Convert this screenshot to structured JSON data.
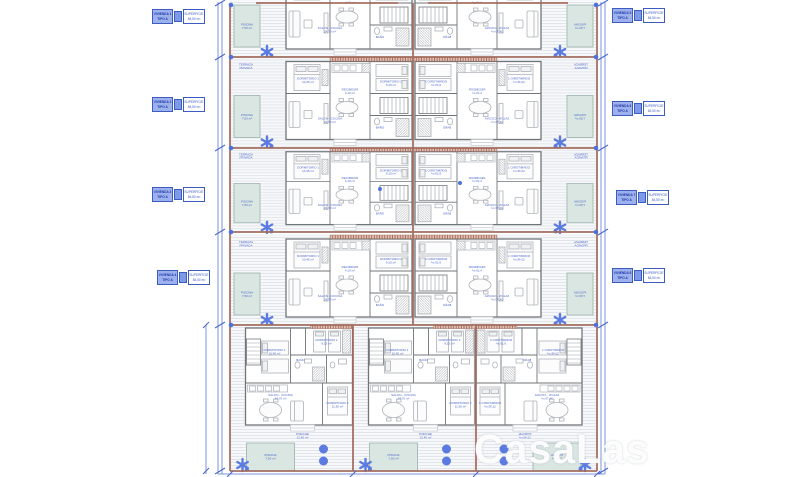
{
  "watermark": "CasaLas",
  "unit_labels": [
    {
      "code_l1": "VIVIENDA 1",
      "code_l2": "TIPO A",
      "info_l1": "SUPERFICIE",
      "info_l2": "84,50 m²"
    },
    {
      "code_l1": "VIVIENDA 2",
      "code_l2": "TIPO A",
      "info_l1": "SUPERFICIE",
      "info_l2": "84,50 m²"
    },
    {
      "code_l1": "VIVIENDA 3",
      "code_l2": "TIPO A",
      "info_l1": "SUPERFICIE",
      "info_l2": "84,50 m²"
    },
    {
      "code_l1": "VIVIENDA 4",
      "code_l2": "TIPO A",
      "info_l1": "SUPERFICIE",
      "info_l2": "84,50 m²"
    },
    {
      "code_l1": "VIVIENDA 5",
      "code_l2": "TIPO A",
      "info_l1": "SUPERFICIE",
      "info_l2": "84,50 m²"
    },
    {
      "code_l1": "VIVIENDA 6",
      "code_l2": "TIPO A",
      "info_l1": "SUPERFICIE",
      "info_l2": "84,50 m²"
    },
    {
      "code_l1": "VIVIENDA 7",
      "code_l2": "TIPO A",
      "info_l1": "SUPERFICIE",
      "info_l2": "84,50 m²"
    },
    {
      "code_l1": "VIVIENDA 8",
      "code_l2": "TIPO A",
      "info_l1": "SUPERFICIE",
      "info_l2": "84,50 m²"
    }
  ],
  "rooms": {
    "terrace_l1": "TERRAZA",
    "terrace_l2": "PRIVADA",
    "pool_l1": "PISCINA",
    "pool_l2": "7,50 m²",
    "bed1_l1": "DORMITORIO 1",
    "bed1_l2": "10,45 m²",
    "bed2_l1": "DORMITORIO 2",
    "bed2_l2": "9,15 m²",
    "bed3_l1": "DORMITORIO 3",
    "bed3_l2": "11,30 m²",
    "living_l1": "SALON - COCINA",
    "living_l2": "24,70 m²",
    "hall_l1": "RECIBIDOR",
    "hall_l2": "4,10 m²",
    "bath": "BAÑO",
    "porch_l1": "PORCHE",
    "porch_l2": "12,40 m²"
  },
  "colors": {
    "accent_blue": "#4d68c8",
    "line_brown": "#a26a5b",
    "pool_fill": "#d9e6e2"
  }
}
